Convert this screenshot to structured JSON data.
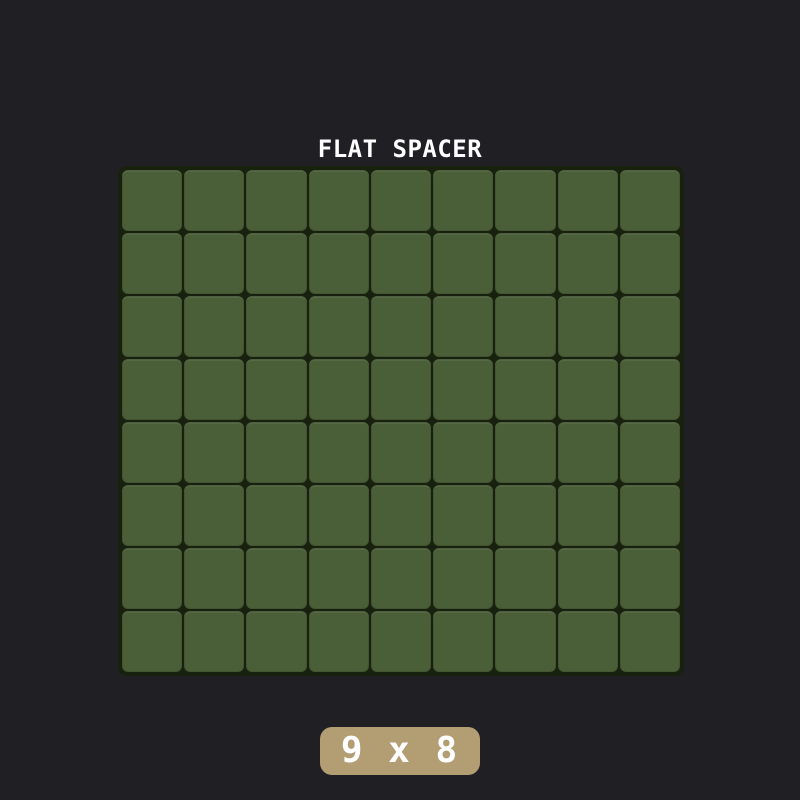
{
  "page": {
    "background_color": "#1f1f24"
  },
  "part_preview": {
    "title": "FLAT SPACER",
    "grid": {
      "columns": 9,
      "rows": 8,
      "cell_color": "#4a5e38",
      "grid_background_color": "#18210e"
    },
    "size_badge": {
      "label": "9 x 8",
      "background_color": "#b39e73",
      "text_color": "#ffffff"
    }
  }
}
